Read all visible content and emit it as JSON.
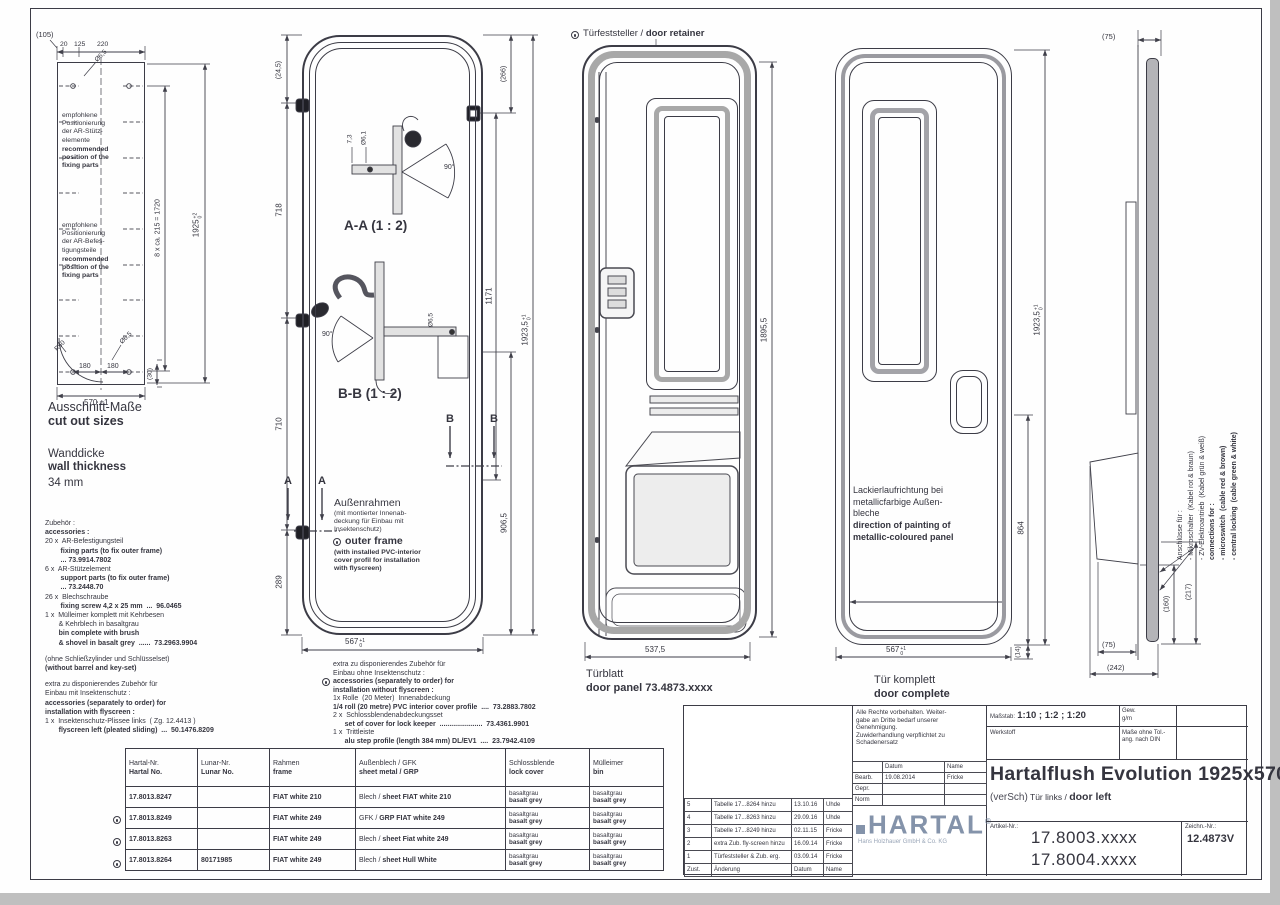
{
  "sheet": {
    "ink": "#35353f",
    "logo_color": "#8493aa"
  },
  "cutout": {
    "corner_dim": "(105)",
    "top_dims": [
      "20",
      "125",
      "220"
    ],
    "hole_dia_top": "Ø6,5",
    "radius_label": "R50",
    "hole_dia_bottom": "Ø6,5",
    "note_support_de": "empfohlene\nPositionierung\nder AR-Stütz-\nelemente",
    "note_support_en": "recommended\nposition of the\nfixing parts",
    "note_fixing_de": "empfohlene\nPositionierung\nder AR-Befes-\ntigungsteile",
    "note_fixing_en": "recommended\nposition of the\nfixing parts",
    "dim_hole_pitch": "8 x ca. 215 = 1720",
    "dim_height": "1925",
    "dim_height_tol_up": "+2",
    "dim_height_tol_dn": "0",
    "dim_180_left": "180",
    "dim_180_right": "180",
    "dim_width": "570 ±1",
    "dim_offset": "(30)",
    "title_de": "Ausschnitt-Maße",
    "title_en": "cut out sizes"
  },
  "wall": {
    "de": "Wanddicke",
    "en": "wall thickness",
    "value": "34 mm"
  },
  "accessories": {
    "lines": [
      {
        "n": "Zubehör :",
        "b": ""
      },
      {
        "n": "",
        "b": "accessories :"
      },
      {
        "n": "20 x  AR-Befestigungsteil",
        "b": ""
      },
      {
        "n": "",
        "b": "        fixing parts (to fix outer frame)"
      },
      {
        "n": "",
        "b": "        ... 73.9914.7802"
      },
      {
        "n": "6 x  AR-Stützelement",
        "b": ""
      },
      {
        "n": "",
        "b": "        support parts (to fix outer frame)"
      },
      {
        "n": "",
        "b": "        ... 73.2448.70"
      },
      {
        "n": "26 x  Blechschraube",
        "b": ""
      },
      {
        "n": "",
        "b": "        fixing screw 4,2 x 25 mm  ...  96.0465"
      },
      {
        "n": "1 x  Mülleimer komplett mit Kehrbesen",
        "b": ""
      },
      {
        "n": "       & Kehrblech in basaltgrau",
        "b": ""
      },
      {
        "n": "",
        "b": "       bin complete with brush"
      },
      {
        "n": "",
        "b": "       & shovel in basalt grey  ......  73.2963.9904"
      },
      {
        "n": "",
        "b": ""
      },
      {
        "n": "(ohne Schließzylinder und Schlüsselset)",
        "b": ""
      },
      {
        "n": "",
        "b": "(without barrel and key-set)"
      },
      {
        "n": "",
        "b": ""
      },
      {
        "n": "extra zu disponierendes Zubehör für",
        "b": ""
      },
      {
        "n": "Einbau mit Insektenschutz :",
        "b": ""
      },
      {
        "n": "",
        "b": "accessories (separately to order) for"
      },
      {
        "n": "",
        "b": "installation with flyscreen :"
      },
      {
        "n": "1 x  Insektenschutz-Plissee links  ( Zg. 12.4413 )",
        "b": ""
      },
      {
        "n": "",
        "b": "       flyscreen left (pleated sliding)  ...  50.1476.8209"
      }
    ]
  },
  "frame_view": {
    "section_a": "A-A  (1 : 2)",
    "section_b": "B-B (1 : 2)",
    "cut_a": "A",
    "cut_b": "B",
    "note_title_de": "Außenrahmen",
    "note_body_de": "(mit montierter Innenab-\ndeckung für Einbau mit\nInsektenschutz)",
    "note_title_en": "outer frame",
    "note_body_en": "(with installed PVC-interior\ncover profil for installation\nwith flyscreen)",
    "dims": {
      "d245": "(24,5)",
      "d718": "718",
      "d710": "710",
      "d289": "289",
      "d266": "(266)",
      "d1171": "1171",
      "d906": "906,5",
      "height": "1923,5",
      "height_up": "+1",
      "height_dn": "0",
      "width": "567",
      "width_up": "+1",
      "width_dn": "0",
      "a1": "7,3",
      "a2": "Ø6,1",
      "a_deg": "90°",
      "b_deg": "90°",
      "b1": "Ø6,5"
    },
    "extra_lines": [
      {
        "n": "extra z​u disponierendes Zubehör für",
        "b": ""
      },
      {
        "n": "Einbau ohne Insektenschutz :",
        "b": ""
      },
      {
        "n": "",
        "b": "accessories (separately to order) for"
      },
      {
        "n": "",
        "b": "installation without flyscreen :"
      },
      {
        "n": "1x Rolle  (20 Meter)  Innenabdeckung",
        "b": ""
      },
      {
        "n": "",
        "b": "1/4 roll (20 metre) PVC interior cover profile  ....  73.2883.7802"
      },
      {
        "n": "2 x  Schlossblendenabdeckungsset",
        "b": ""
      },
      {
        "n": "",
        "b": "      set of cover for lock keeper  ......................  73.4361.9901"
      },
      {
        "n": "1 x  Trittleiste",
        "b": ""
      },
      {
        "n": "",
        "b": "      alu step profile (length 384 mm) DL/EV1  ....  23.7942.4109"
      }
    ]
  },
  "door_panel": {
    "retainer_de": "Türfeststeller / ",
    "retainer_en": "door retainer",
    "dim_height": "1895,5",
    "dim_width": "537,5",
    "label_de": "Türblatt",
    "label_en": "door panel  73.4873.xxxx"
  },
  "door_complete": {
    "paint_de": "Lackierlaufrichtung bei\nmetallicfarbige Außen-\nbleche",
    "paint_en": "direction of painting of\nmetallic-coloured panel",
    "dim_handle": "864",
    "dim_height": "1923,5",
    "height_up": "+1",
    "height_dn": "0",
    "dim_gap": "(14)",
    "dim_width": "567",
    "width_up": "+1",
    "width_dn": "0",
    "label_de": "Tür  komplett",
    "label_en": "door complete"
  },
  "side_view": {
    "dim_top": "(75)",
    "dim_b75": "(75)",
    "dim_242": "(242)",
    "dim_160": "(160)",
    "dim_217": "(217)",
    "conn_lines": [
      {
        "n": "Anschlüsse für :",
        "b": ""
      },
      {
        "n": "- Mikroschalter  (Kabel rot & braun)",
        "b": ""
      },
      {
        "n": "- ZV-Elektroantrieb  (Kabel grün & weiß)",
        "b": ""
      },
      {
        "n": "",
        "b": "connections for :"
      },
      {
        "n": "",
        "b": "- microswitch  (cable red & brown)"
      },
      {
        "n": "",
        "b": "- central locking  (cable green & white)"
      }
    ]
  },
  "parts_table": {
    "headers": [
      {
        "de": "Hartal-Nr.",
        "en": "Hartal No."
      },
      {
        "de": "Lunar-Nr.",
        "en": "Lunar No."
      },
      {
        "de": "Rahmen",
        "en": "frame"
      },
      {
        "de": "Außenblech / GFK",
        "en": "sheet metal  / GRP"
      },
      {
        "de": "Schlossblende",
        "en": "lock cover"
      },
      {
        "de": "Mülleimer",
        "en": "bin"
      }
    ],
    "rows": [
      {
        "hartal": "17.8013.8247",
        "lunar": "",
        "frame": "FIAT white 210",
        "sheet_n": "Blech / ",
        "sheet_b": "sheet FIAT white 210",
        "lock_n": "basaltgrau",
        "lock_b": "basalt grey",
        "bin_n": "basaltgrau",
        "bin_b": "basalt grey"
      },
      {
        "hartal": "17.8013.8249",
        "lunar": "",
        "frame": "FIAT white 249",
        "sheet_n": "GFK / ",
        "sheet_b": "GRP FIAT white 249",
        "lock_n": "basaltgrau",
        "lock_b": "basalt grey",
        "bin_n": "basaltgrau",
        "bin_b": "basalt grey"
      },
      {
        "hartal": "17.8013.8263",
        "lunar": "",
        "frame": "FIAT white 249",
        "sheet_n": "Blech / ",
        "sheet_b": "sheet Fiat white 249",
        "lock_n": "basaltgrau",
        "lock_b": "basalt grey",
        "bin_n": "basaltgrau",
        "bin_b": "basalt grey"
      },
      {
        "hartal": "17.8013.8264",
        "lunar": "80171985",
        "frame": "FIAT white 249",
        "sheet_n": "Blech / ",
        "sheet_b": "sheet Hull White",
        "lock_n": "basaltgrau",
        "lock_b": "basalt grey",
        "bin_n": "basaltgrau",
        "bin_b": "basalt grey"
      }
    ]
  },
  "title_block": {
    "legal": "Alle Rechte vorbehalten. Weiter-\ngabe an Dritte bedarf unserer\nGenehmigung.\nZuwiderhandlung verpflichtet zu\nSchadenersatz",
    "approval": {
      "datum": "Datum",
      "name": "Name",
      "rows": [
        {
          "l": "Bearb.",
          "d": "19.08.2014",
          "n": "Fricke"
        },
        {
          "l": "Gepr.",
          "d": "",
          "n": ""
        },
        {
          "l": "Norm",
          "d": "",
          "n": ""
        }
      ]
    },
    "logo": {
      "text": "HARTAL",
      "reg": "®",
      "subtitle": "Hans Holzhauer GmbH & Co. KG"
    },
    "scale_label": "Maßstab:",
    "scale": "1:10  ;  1:2  ;  1:20",
    "gew": "Gew.",
    "gew2": "g/m",
    "werkstoff": "Werkstoff",
    "tol_note": "Maße ohne Tol.-\nang. nach DIN",
    "title": "Hartalflush Evolution 1925x570",
    "subtitle_a": "(verSch)",
    "subtitle_b": " Tür links / ",
    "subtitle_c": "door left",
    "artikel_label": "Artikel-Nr.:",
    "artikel1": "17.8003.xxxx",
    "artikel2": "17.8004.xxxx",
    "zeichn_label": "Zeichn.-Nr.:",
    "zeichn": "12.4873V",
    "rev_rows": [
      {
        "z": "5",
        "a": "Tabelle 17...8264 hinzu",
        "d": "13.10.16",
        "n": "Uhde"
      },
      {
        "z": "4",
        "a": "Tabelle 17...8263 hinzu",
        "d": "29.09.16",
        "n": "Uhde"
      },
      {
        "z": "3",
        "a": "Tabelle 17...8249 hinzu",
        "d": "02.11.15",
        "n": "Fricke"
      },
      {
        "z": "2",
        "a": "extra Zub. fly-screen hinzu",
        "d": "16.09.14",
        "n": "Fricke"
      },
      {
        "z": "1",
        "a": "Türfeststeller & Zub. erg.",
        "d": "03.09.14",
        "n": "Fricke"
      }
    ],
    "rev_footer": {
      "z": "Zust.",
      "a": "Änderung",
      "d": "Datum",
      "n": "Name"
    }
  }
}
